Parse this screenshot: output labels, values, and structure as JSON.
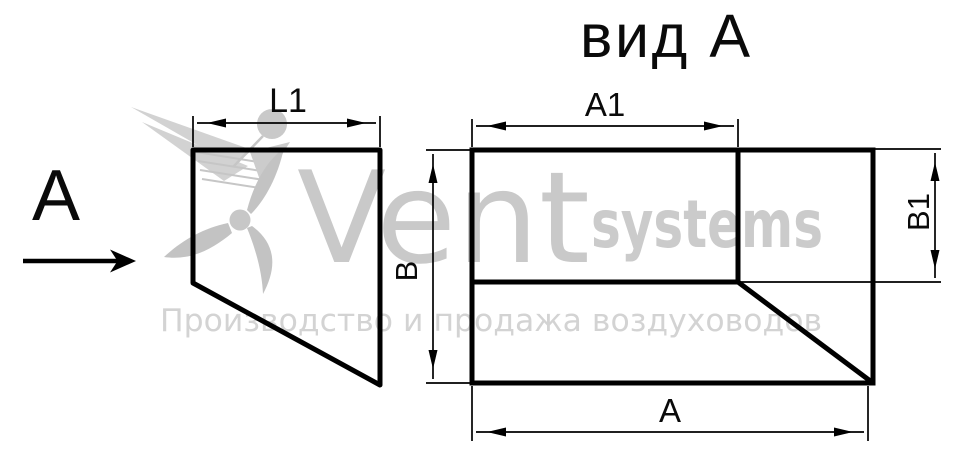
{
  "title": "вид А",
  "left_view": {
    "view_arrow_label": "А",
    "dim_l1_label": "L1"
  },
  "front_view": {
    "dim_a1_label": "А1",
    "dim_b_label": "В",
    "dim_b1_label": "В1",
    "dim_a_label": "А"
  },
  "watermark": {
    "brand_primary": "Vent",
    "brand_secondary": "systems",
    "tagline": "Производство и продажа воздуховодов"
  },
  "colors": {
    "line": "#000000",
    "watermark_brand": "#c9c9c9",
    "watermark_tagline": "#d3d3d3"
  }
}
